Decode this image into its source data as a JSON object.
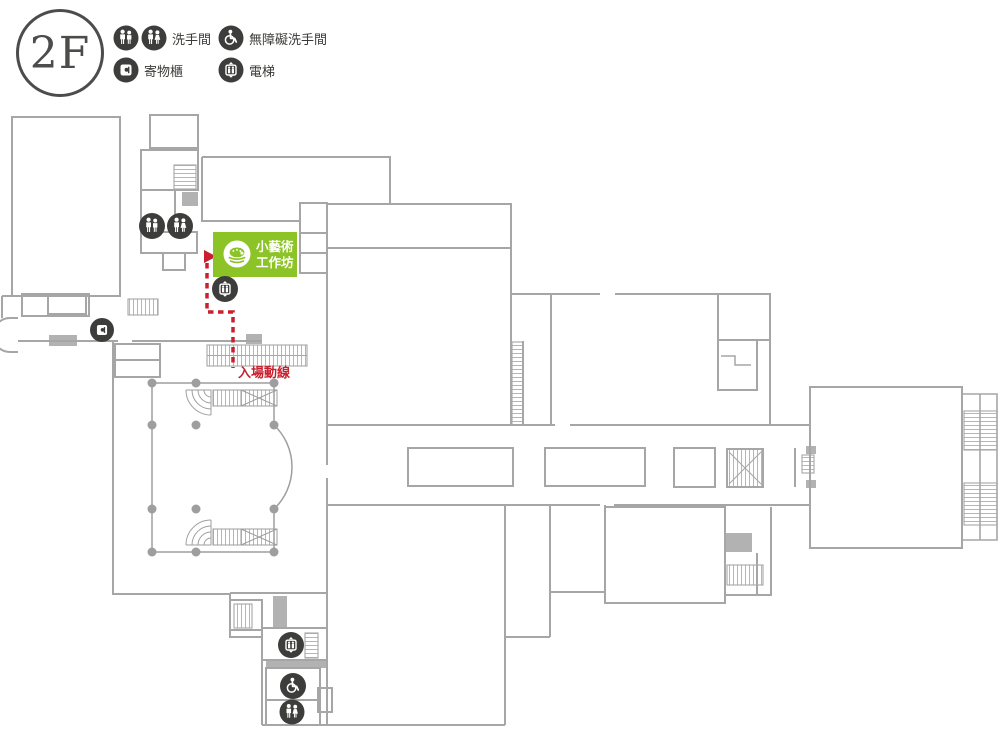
{
  "floor_label": "2F",
  "legend": {
    "restroom_label": "洗手間",
    "accessible_label": "無障礙洗手間",
    "locker_label": "寄物櫃",
    "elevator_label": "電梯"
  },
  "map": {
    "workshop_line1": "小藝術",
    "workshop_line2": "工作坊",
    "route_label": "入場動線"
  },
  "colors": {
    "highlight_green": "#8CC327",
    "route_red": "#C8202E",
    "icon_dark": "#3D3D3B",
    "wall_gray": "#A6A6A6",
    "text_dark": "#3A3A38"
  }
}
